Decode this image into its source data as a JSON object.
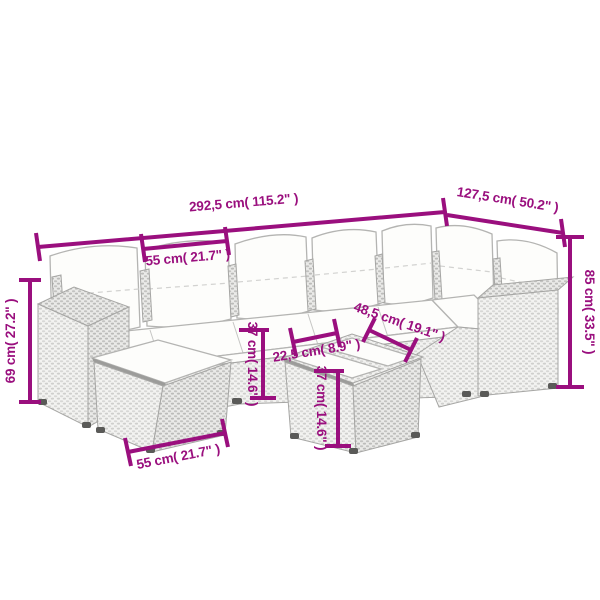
{
  "image_type": "product dimension diagram",
  "product": "poly rattan garden lounge set with cushions (line drawing)",
  "colors": {
    "background": "#ffffff",
    "dimension_accent": "#9a0f7e",
    "line_art": "#b4b4b2",
    "cushion": "#fdfdfb"
  },
  "dimensions": [
    {
      "part": "sofa total width",
      "label": "292,5 cm( 115.2\" )",
      "cm": "292,5",
      "inch": "115.2"
    },
    {
      "part": "corner section depth",
      "label": "127,5 cm( 50.2\" )",
      "cm": "127,5",
      "inch": "50.2"
    },
    {
      "part": "seat module width",
      "label": "55 cm( 21.7\" )",
      "cm": "55",
      "inch": "21.7"
    },
    {
      "part": "backrest height",
      "label": "85 cm( 33.5\" )",
      "cm": "85",
      "inch": "33.5"
    },
    {
      "part": "side cube height",
      "label": "69 cm( 27.2\" )",
      "cm": "69",
      "inch": "27.2"
    },
    {
      "part": "seat height",
      "label": "37 cm( 14.6\" )",
      "cm": "37",
      "inch": "14.6"
    },
    {
      "part": "glass panel width",
      "label": "22,5 cm( 8.9\" )",
      "cm": "22,5",
      "inch": "8.9"
    },
    {
      "part": "coffee table width",
      "label": "48,5 cm( 19.1\" )",
      "cm": "48,5",
      "inch": "19.1"
    },
    {
      "part": "coffee table height",
      "label": "37 cm( 14.6\" )",
      "cm": "37",
      "inch": "14.6"
    },
    {
      "part": "footstool width",
      "label": "55 cm( 21.7\" )",
      "cm": "55",
      "inch": "21.7"
    }
  ]
}
